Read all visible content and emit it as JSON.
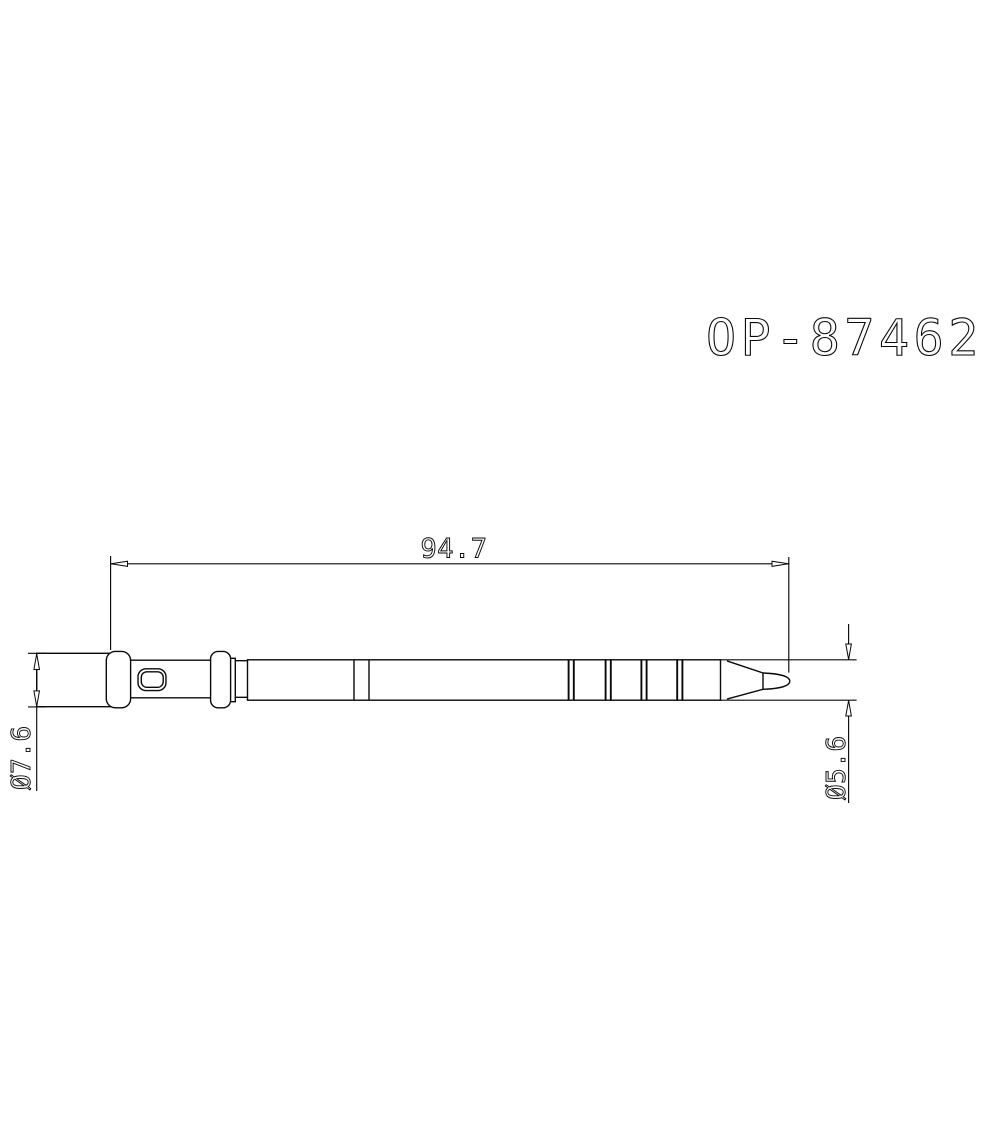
{
  "title": "OP-87462",
  "dimensions": {
    "overall_length": "94.7",
    "body_diameter": "Ø7.6",
    "tip_diameter": "Ø5.6"
  },
  "colors": {
    "line": "#0a0a0a",
    "background": "#ffffff"
  }
}
